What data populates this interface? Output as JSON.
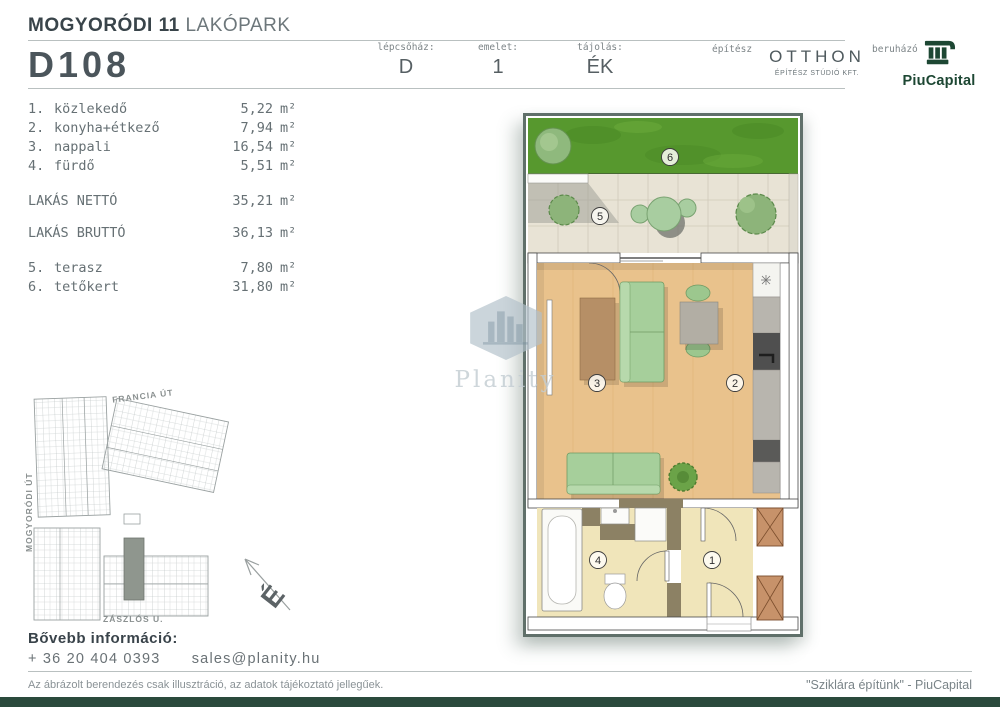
{
  "header": {
    "project": {
      "bold": "MOGYORÓDI 11",
      "light": "LAKÓPARK"
    },
    "unit_id": "D108",
    "fields": [
      {
        "label": "lépcsőház:",
        "value": "D"
      },
      {
        "label": "emelet:",
        "value": "1"
      },
      {
        "label": "tájolás:",
        "value": "ÉK"
      }
    ],
    "architect": {
      "label": "építész",
      "name": "OTTHON",
      "sub": "ÉPÍTÉSZ STÚDIÓ KFT."
    },
    "developer": {
      "label": "beruházó",
      "name": "PiuCapital"
    }
  },
  "rooms": {
    "items": [
      {
        "num": "1.",
        "name": "közlekedő",
        "area": "5,22",
        "unit": "m²"
      },
      {
        "num": "2.",
        "name": "konyha+étkező",
        "area": "7,94",
        "unit": "m²"
      },
      {
        "num": "3.",
        "name": "nappali",
        "area": "16,54",
        "unit": "m²"
      },
      {
        "num": "4.",
        "name": "fürdő",
        "area": "5,51",
        "unit": "m²"
      }
    ],
    "totals": [
      {
        "name": "LAKÁS NETTÓ",
        "area": "35,21",
        "unit": "m²"
      },
      {
        "name": "LAKÁS BRUTTÓ",
        "area": "36,13",
        "unit": "m²"
      }
    ],
    "outdoor": [
      {
        "num": "5.",
        "name": "terasz",
        "area": "7,80",
        "unit": "m²"
      },
      {
        "num": "6.",
        "name": "tetőkert",
        "area": "31,80",
        "unit": "m²"
      }
    ]
  },
  "floorplan": {
    "labels": {
      "garden": "6",
      "terrace": "5",
      "living": "3",
      "kitchen": "2",
      "bath": "4",
      "hall": "1"
    }
  },
  "siteplan": {
    "street_top": "FRANCIA ÚT",
    "street_left": "MOGYORÓDI ÚT",
    "street_bottom": "ZÁSZLÓS U.",
    "compass_north": "É"
  },
  "watermark": {
    "brand": "Planity"
  },
  "contact": {
    "heading": "Bővebb információ:",
    "phone": "+ 36 20 404 0393",
    "email": "sales@planity.hu"
  },
  "footer": {
    "disclaimer": "Az ábrázolt berendezés csak illusztráció, az adatok tájékoztató jellegűek.",
    "slogan": "\"Sziklára építünk\" - PiuCapital"
  },
  "colors": {
    "brand_green": "#1d4733",
    "footer_bar": "#2a4a3c",
    "grass": "#57982e",
    "wood_floor": "#e9c28c",
    "terrace_tile": "#e8e3d5",
    "pale_floor": "#f0e5ba",
    "sofa_green": "#a6cf9b",
    "wall_brown": "#8c8164",
    "shaft_brown": "#c7926a"
  }
}
